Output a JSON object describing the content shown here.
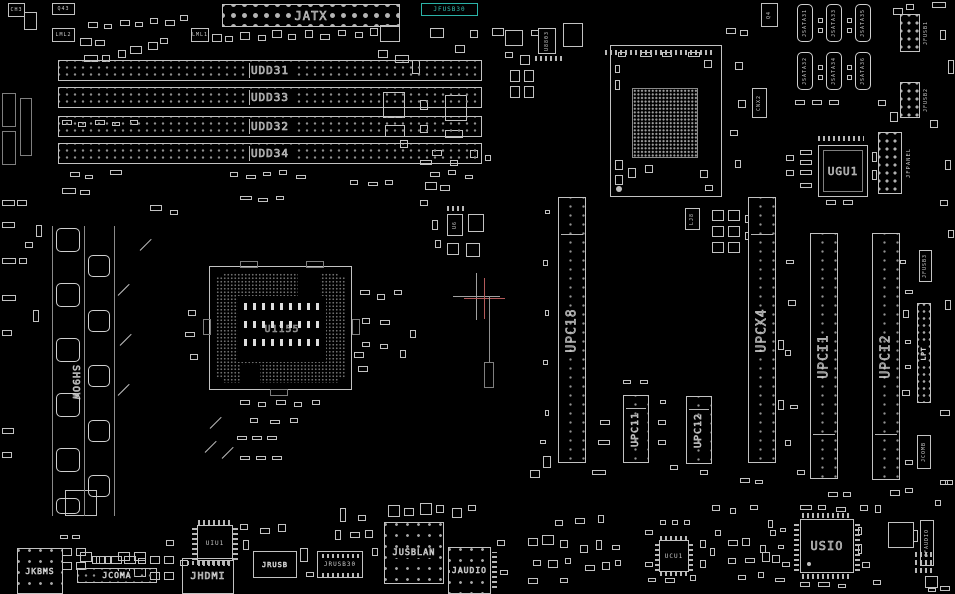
{
  "view": {
    "type": "pcb-boardview",
    "background": "#000000",
    "silkscreen_color": "#c8c8c8",
    "highlight_color": "#2bb3a8",
    "crosshair_color": "#a0a0a0",
    "crosshair_accent": "#b35a5a"
  },
  "chips": {
    "ch3": "CH3",
    "q43": "Q43",
    "lml2": "LML2",
    "lml1": "LML1",
    "q4": "Q4",
    "cnx2": "CNX2",
    "u8803": "U8803",
    "u6": "U6",
    "lj8": "LJ8",
    "ugu1": "UGU1",
    "usio": "USIO",
    "ucu1": "UCU1",
    "uiu1": "UIU1",
    "socket_label": "U1155",
    "vrm_label": "SH9OW"
  },
  "power": {
    "jatx": "JATX"
  },
  "dimm_slots": [
    {
      "label": "UDD31"
    },
    {
      "label": "UDD33"
    },
    {
      "label": "UDD32"
    },
    {
      "label": "UDD34"
    }
  ],
  "expansion_slots": {
    "upc18": "UPC18",
    "upc11": "UPC11",
    "upc12": "UPC12",
    "upcx4": "UPCX4",
    "upci1": "UPCI1",
    "upci2": "UPCI2"
  },
  "sata_ports": [
    "JSATA31",
    "JSATA33",
    "JSATA35",
    "JSATA32",
    "JSATA34",
    "JSATA36"
  ],
  "headers": {
    "jfusb30": "JFUSB30",
    "jfusb1": "JFUSB1",
    "jfusb2": "JFUSB2",
    "jfusb3": "JFUSB3",
    "jfpanel": "JFPANEL",
    "lpt": "LPT",
    "jcomb": "JCOMB",
    "jfaudio": "JFAUDIO"
  },
  "rear_io": {
    "jkbms": "JKBMS",
    "jcoma": "JCOMA",
    "jhdmi": "JHDMI",
    "jrusb": "JRUSB",
    "jrusb30": "JRUSB30",
    "jusblan": "JUSBLAN",
    "jaudio": "JAUDIO"
  }
}
